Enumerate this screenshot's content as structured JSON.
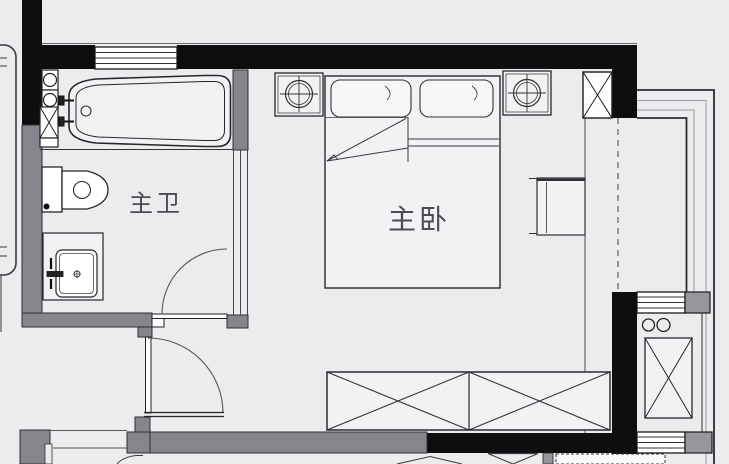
{
  "meta": {
    "title": "residential floor plan – master suite",
    "drawing_type": "floor-plan"
  },
  "rooms": [
    {
      "id": "master-bathroom",
      "label": "主卫"
    },
    {
      "id": "master-bedroom",
      "label": "主卧"
    }
  ],
  "fixtures": [
    "bathtub",
    "bathtub-faucet",
    "toilet",
    "vanity-sink",
    "duct-shaft-box",
    "control-knobs",
    "double-bed",
    "pillow",
    "nightstand-lamp",
    "nightstand-lamp",
    "ceiling-column-box",
    "desk",
    "wardrobe",
    "washer-unit",
    "balcony-knobs",
    "window",
    "window",
    "window",
    "swing-door",
    "swing-door"
  ],
  "colors": {
    "background": "#ececee",
    "wall_black": "#0e0e10",
    "wall_gray": "#85858b",
    "fixture_line": "#26262b",
    "window_fill": "#ffffff",
    "label_text": "#4b4b52"
  }
}
